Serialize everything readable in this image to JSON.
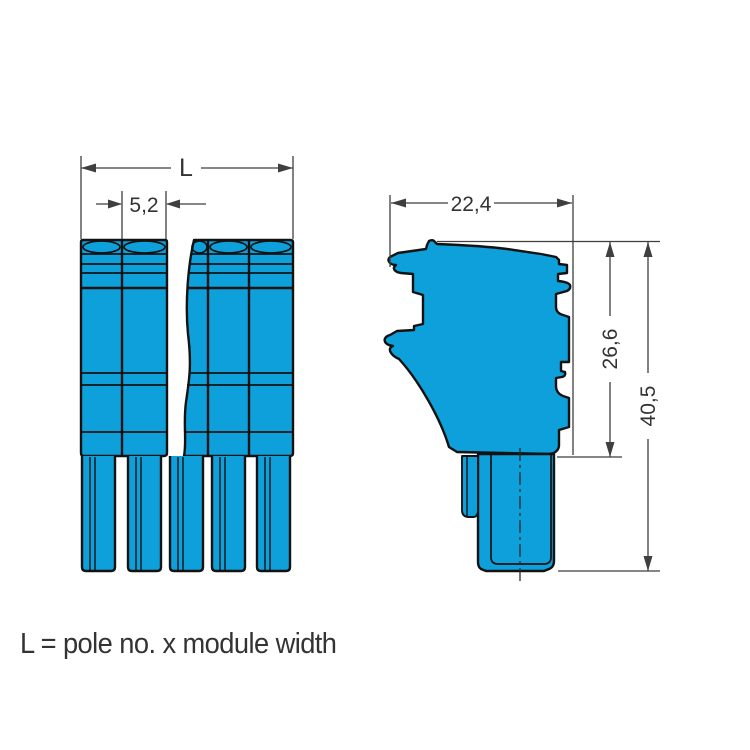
{
  "drawing": {
    "caption": "L = pole no. x module width",
    "front_view": {
      "name": "front view of multi-pole female plug connector",
      "poles_visible": 5,
      "dim_total_width_label": "L",
      "dim_module_width_label": "5,2"
    },
    "side_view": {
      "name": "side profile of connector housing with pin",
      "dim_depth_label": "22,4",
      "dim_housing_height_label": "26,6",
      "dim_total_height_label": "40,5"
    },
    "colors": {
      "body_fill": "#0da0da",
      "outline": "#121212",
      "dimension_lines": "#3f3f3f",
      "text": "#333333",
      "background": "#ffffff"
    }
  }
}
